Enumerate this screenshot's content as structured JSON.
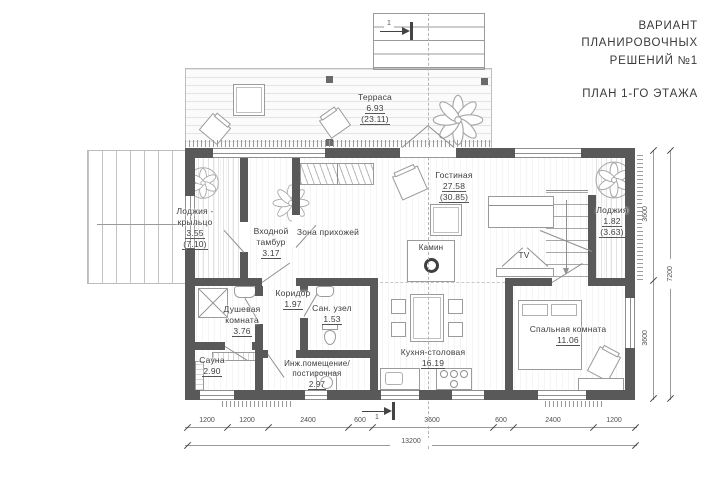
{
  "title": {
    "line1": "ВАРИАНТ",
    "line2": "ПЛАНИРОВОЧНЫХ",
    "line3": "РЕШЕНИЙ №1",
    "plan": "ПЛАН 1-ГО ЭТАЖА"
  },
  "rooms": {
    "terrace": {
      "name": "Терраса",
      "area": "6.93",
      "area_total": "(23.11)"
    },
    "loggia_porch": {
      "name": "Лоджия - крыльцо",
      "area": "3.55",
      "area_total": "(7.10)"
    },
    "vestibule": {
      "name": "Входной тамбур",
      "area": "3.17"
    },
    "hallway": {
      "name": "Зона прихожей"
    },
    "living": {
      "name": "Гостиная",
      "area": "27.58",
      "area_total": "(30.85)"
    },
    "fireplace": {
      "name": "Камин"
    },
    "tv": {
      "name": "TV"
    },
    "loggia": {
      "name": "Лоджия",
      "area": "1.82",
      "area_total": "(3.63)"
    },
    "shower": {
      "name": "Душевая комната",
      "area": "3.76"
    },
    "corridor": {
      "name": "Коридор",
      "area": "1.97"
    },
    "wc": {
      "name": "Сан. узел",
      "area": "1.53"
    },
    "sauna": {
      "name": "Сауна",
      "area": "2.90"
    },
    "utility": {
      "name": "Инж.помещение/",
      "name2": "постирочная",
      "area": "2.97"
    },
    "kitchen": {
      "name": "Кухня-столовая",
      "area": "16.19"
    },
    "bedroom": {
      "name": "Спальная комната",
      "area": "11.06"
    }
  },
  "dimensions": {
    "bottom": [
      "1200",
      "1200",
      "2400",
      "600",
      "3600",
      "600",
      "2400",
      "1200"
    ],
    "bottom_total": "13200",
    "right": [
      "3600",
      "3600"
    ],
    "right_total": "7200",
    "section_mark": "1"
  },
  "colors": {
    "wall": "#595959",
    "line": "#9a9a9a",
    "text": "#3d3d3d"
  }
}
